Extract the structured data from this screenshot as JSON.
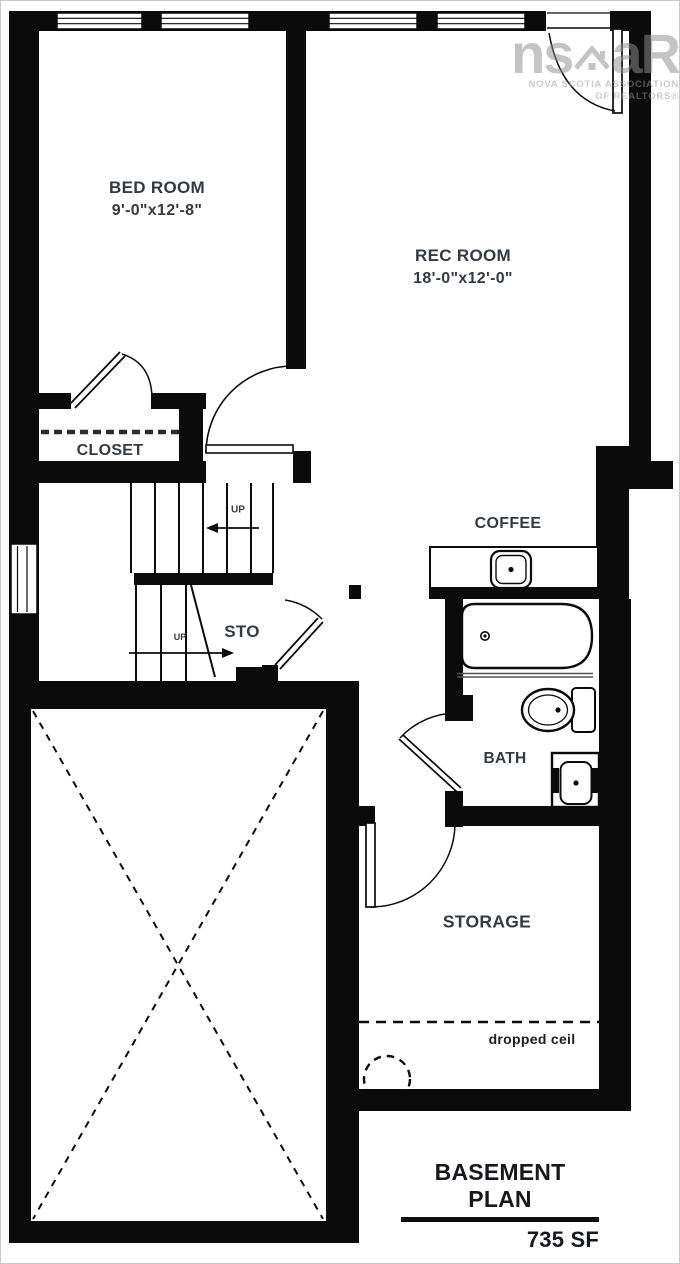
{
  "title_block": {
    "title": "BASEMENT PLAN",
    "area": "735 SF"
  },
  "rooms": {
    "bedroom": {
      "name": "BED ROOM",
      "dims": "9'-0\"x12'-8\""
    },
    "rec_room": {
      "name": "REC ROOM",
      "dims": "18'-0\"x12'-0\""
    },
    "closet": {
      "name": "CLOSET"
    },
    "storage_under_stairs": {
      "name": "STO"
    },
    "bath": {
      "name": "BATH"
    },
    "storage": {
      "name": "STORAGE"
    }
  },
  "fixtures": {
    "coffee_bar": "COFFEE"
  },
  "stairs": {
    "up_label_1": "UP",
    "up_label_2": "UP"
  },
  "notes": {
    "dropped_ceiling": "dropped ceil"
  },
  "watermark": {
    "logo_left": "ns",
    "logo_right": "aR",
    "org_line1": "NOVA SCOTIA ASSOCIATION",
    "org_line2": "OF REALTORS®"
  },
  "colors": {
    "ink": "#0b0b0b",
    "label": "#343a42",
    "watermark_gray": "#8f8f8f"
  }
}
